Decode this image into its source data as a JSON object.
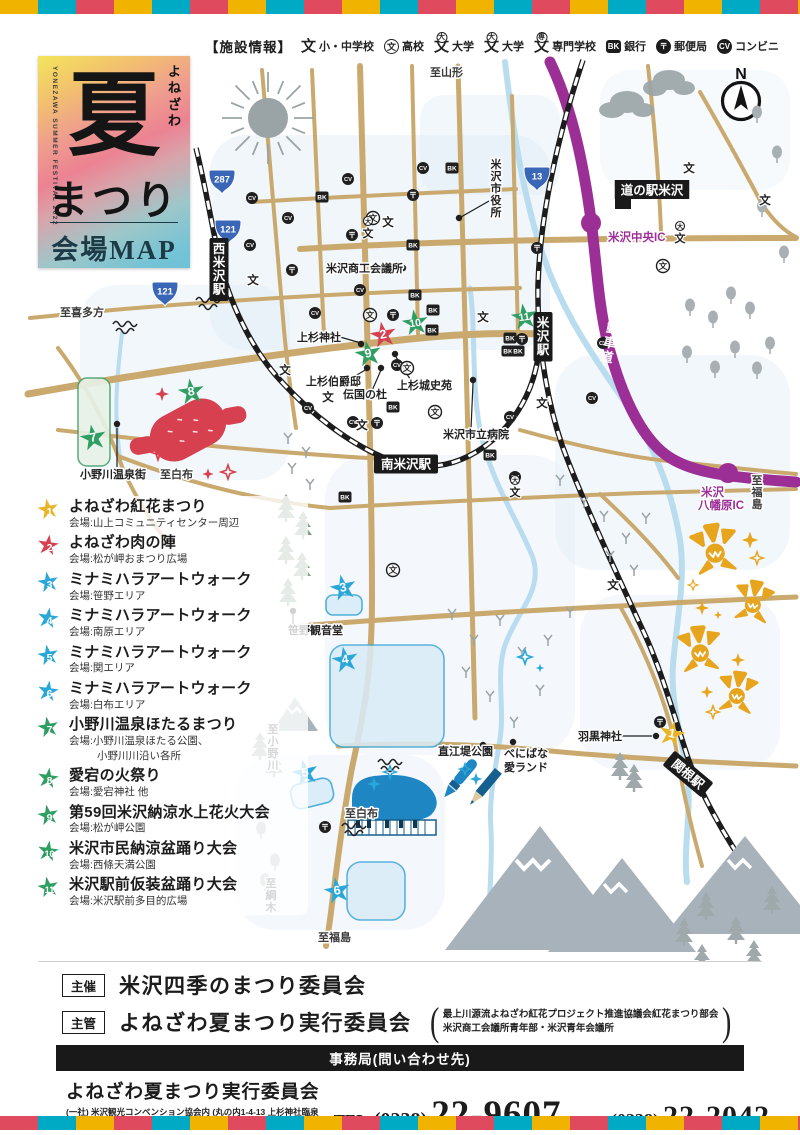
{
  "colors": {
    "stripe": [
      "#f0b400",
      "#00a9c4",
      "#e04a5e"
    ],
    "road_tan": "#c9a96e",
    "railway": "#1c1c1c",
    "expressway_purple": "#9c2f96",
    "river_blue": "#b9dcee",
    "star_yellow": "#e8b42a",
    "star_red": "#d6404f",
    "star_cyan": "#2aa7d8",
    "star_green": "#2f9e62"
  },
  "legend": {
    "title": "【施設情報】",
    "items": [
      {
        "icon": "elementary-junior-school-icon",
        "glyph": "文",
        "badge": "plain",
        "label": "小・中学校"
      },
      {
        "icon": "high-school-icon",
        "glyph": "文",
        "badge": "ring",
        "label": "高校"
      },
      {
        "icon": "university-icon",
        "glyph": "文",
        "badge": "大",
        "label": "大学"
      },
      {
        "icon": "university-icon-2",
        "glyph": "文",
        "badge": "大",
        "label": "大学"
      },
      {
        "icon": "vocational-school-icon",
        "glyph": "文",
        "badge": "専",
        "label": "専門学校"
      },
      {
        "icon": "bank-icon",
        "glyph": "BK",
        "badge": "square",
        "label": "銀行"
      },
      {
        "icon": "post-office-icon",
        "glyph": "〒",
        "badge": "disc",
        "label": "郵便局"
      },
      {
        "icon": "convenience-store-icon",
        "glyph": "CV",
        "badge": "disc",
        "label": "コンビニ"
      }
    ]
  },
  "title_card": {
    "vertical_en": "YONEZAWA SUMMER FESTIVAL 2022",
    "kana": "よねざわ",
    "logo_char": "夏",
    "subtitle": "まつり",
    "map_label": "会場MAP"
  },
  "map": {
    "compass_label": "N",
    "expressway_label": "東北中央自動車道",
    "shields": [
      {
        "num": "287",
        "x": 222,
        "y": 181
      },
      {
        "num": "121",
        "x": 228,
        "y": 231
      },
      {
        "num": "121",
        "x": 165,
        "y": 293
      },
      {
        "num": "13",
        "x": 537,
        "y": 178
      }
    ],
    "stations": [
      {
        "name": "南米沢駅",
        "x": 406,
        "y": 464,
        "o": "h",
        "rot": 0
      },
      {
        "name": "米沢駅",
        "x": 543,
        "y": 312,
        "o": "v"
      },
      {
        "name": "西米沢駅",
        "x": 219,
        "y": 238,
        "o": "v"
      },
      {
        "name": "関根駅",
        "x": 688,
        "y": 774,
        "o": "h",
        "rot": 40
      }
    ],
    "labels": [
      {
        "text": "N",
        "x": 741,
        "y": 79,
        "s": "compass"
      },
      {
        "text": "至山形",
        "x": 430,
        "y": 76,
        "s": "dir"
      },
      {
        "text": "至喜多方",
        "x": 60,
        "y": 316,
        "s": "dir"
      },
      {
        "text": "至白布",
        "x": 160,
        "y": 478,
        "s": "dir"
      },
      {
        "text": "至白布",
        "x": 345,
        "y": 817,
        "s": "dir"
      },
      {
        "text": "至福島",
        "x": 318,
        "y": 941,
        "s": "dir"
      },
      {
        "text": "至小野川",
        "x": 273,
        "y": 733,
        "s": "dirv"
      },
      {
        "text": "至綱木",
        "x": 271,
        "y": 887,
        "s": "dirv"
      },
      {
        "text": "至福島",
        "x": 757,
        "y": 484,
        "s": "dirv"
      },
      {
        "text": "米沢市役所",
        "x": 496,
        "y": 168,
        "s": "placev"
      },
      {
        "text": "道の駅米沢",
        "x": 652,
        "y": 190,
        "s": "blackbox"
      },
      {
        "text": "米沢中央IC",
        "x": 608,
        "y": 241,
        "s": "purple"
      },
      {
        "text": "米沢",
        "x": 701,
        "y": 496,
        "s": "purple"
      },
      {
        "text": "八幡原IC",
        "x": 698,
        "y": 509,
        "s": "purple"
      },
      {
        "text": "米沢商工会議所",
        "x": 326,
        "y": 272,
        "s": "place"
      },
      {
        "text": "上杉神社",
        "x": 297,
        "y": 341,
        "s": "place"
      },
      {
        "text": "上杉伯爵邸",
        "x": 306,
        "y": 385,
        "s": "place"
      },
      {
        "text": "伝国の杜",
        "x": 343,
        "y": 398,
        "s": "place"
      },
      {
        "text": "上杉城史苑",
        "x": 397,
        "y": 389,
        "s": "place"
      },
      {
        "text": "米沢市立病院",
        "x": 443,
        "y": 438,
        "s": "place"
      },
      {
        "text": "小野川温泉街",
        "x": 80,
        "y": 478,
        "s": "place"
      },
      {
        "text": "笹野観音堂",
        "x": 288,
        "y": 634,
        "s": "place"
      },
      {
        "text": "直江堤公園",
        "x": 438,
        "y": 755,
        "s": "place"
      },
      {
        "text": "べにばな",
        "x": 504,
        "y": 757,
        "s": "place"
      },
      {
        "text": "愛ランド",
        "x": 504,
        "y": 771,
        "s": "place"
      },
      {
        "text": "羽黒神社",
        "x": 578,
        "y": 740,
        "s": "place"
      }
    ],
    "stars": [
      {
        "n": 1,
        "x": 672,
        "y": 733,
        "rot": 12
      },
      {
        "n": 2,
        "x": 383,
        "y": 334,
        "rot": -10
      },
      {
        "n": 3,
        "x": 343,
        "y": 587,
        "rot": -12
      },
      {
        "n": 4,
        "x": 345,
        "y": 659,
        "rot": -10
      },
      {
        "n": 5,
        "x": 305,
        "y": 772,
        "rot": -12
      },
      {
        "n": 6,
        "x": 337,
        "y": 890,
        "rot": -10
      },
      {
        "n": 7,
        "x": 93,
        "y": 437,
        "rot": -10
      },
      {
        "n": 8,
        "x": 191,
        "y": 391,
        "rot": -8
      },
      {
        "n": 9,
        "x": 368,
        "y": 353,
        "rot": -10
      },
      {
        "n": 10,
        "x": 415,
        "y": 322,
        "rot": -8
      },
      {
        "n": 11,
        "x": 524,
        "y": 316,
        "rot": -8
      }
    ],
    "facility_icons": [
      {
        "t": "bk",
        "x": 322,
        "y": 197
      },
      {
        "t": "bk",
        "x": 452,
        "y": 168
      },
      {
        "t": "bk",
        "x": 413,
        "y": 245
      },
      {
        "t": "bk",
        "x": 415,
        "y": 295
      },
      {
        "t": "bk",
        "x": 433,
        "y": 310
      },
      {
        "t": "bk",
        "x": 432,
        "y": 330
      },
      {
        "t": "bk",
        "x": 510,
        "y": 338
      },
      {
        "t": "bk",
        "x": 508,
        "y": 351
      },
      {
        "t": "bk",
        "x": 518,
        "y": 351
      },
      {
        "t": "bk",
        "x": 393,
        "y": 407
      },
      {
        "t": "bk",
        "x": 490,
        "y": 455
      },
      {
        "t": "bk",
        "x": 345,
        "y": 497
      },
      {
        "t": "cv",
        "x": 348,
        "y": 179
      },
      {
        "t": "cv",
        "x": 252,
        "y": 198
      },
      {
        "t": "cv",
        "x": 288,
        "y": 218
      },
      {
        "t": "cv",
        "x": 250,
        "y": 245
      },
      {
        "t": "cv",
        "x": 423,
        "y": 168
      },
      {
        "t": "cv",
        "x": 360,
        "y": 290
      },
      {
        "t": "cv",
        "x": 315,
        "y": 313
      },
      {
        "t": "cv",
        "x": 397,
        "y": 365
      },
      {
        "t": "cv",
        "x": 308,
        "y": 408
      },
      {
        "t": "cv",
        "x": 353,
        "y": 422
      },
      {
        "t": "cv",
        "x": 510,
        "y": 417
      },
      {
        "t": "cv",
        "x": 515,
        "y": 477
      },
      {
        "t": "cv",
        "x": 603,
        "y": 343
      },
      {
        "t": "cv",
        "x": 592,
        "y": 398
      },
      {
        "t": "post",
        "x": 413,
        "y": 195
      },
      {
        "t": "post",
        "x": 352,
        "y": 235
      },
      {
        "t": "post",
        "x": 292,
        "y": 270
      },
      {
        "t": "post",
        "x": 537,
        "y": 248
      },
      {
        "t": "post",
        "x": 393,
        "y": 315
      },
      {
        "t": "post",
        "x": 522,
        "y": 339
      },
      {
        "t": "post",
        "x": 377,
        "y": 423
      },
      {
        "t": "post",
        "x": 325,
        "y": 827
      },
      {
        "t": "post",
        "x": 660,
        "y": 722
      },
      {
        "t": "school",
        "x": 388,
        "y": 222
      },
      {
        "t": "school",
        "x": 253,
        "y": 280
      },
      {
        "t": "school",
        "x": 285,
        "y": 370
      },
      {
        "t": "school",
        "x": 328,
        "y": 397
      },
      {
        "t": "school",
        "x": 362,
        "y": 425
      },
      {
        "t": "school",
        "x": 542,
        "y": 403
      },
      {
        "t": "school",
        "x": 483,
        "y": 317
      },
      {
        "t": "school",
        "x": 613,
        "y": 585
      },
      {
        "t": "school",
        "x": 689,
        "y": 168
      },
      {
        "t": "school",
        "x": 765,
        "y": 200
      },
      {
        "t": "hs",
        "x": 373,
        "y": 218
      },
      {
        "t": "hs",
        "x": 407,
        "y": 368
      },
      {
        "t": "hs",
        "x": 435,
        "y": 412
      },
      {
        "t": "hs",
        "x": 370,
        "y": 315
      },
      {
        "t": "hs",
        "x": 663,
        "y": 266
      },
      {
        "t": "hs",
        "x": 393,
        "y": 570
      },
      {
        "t": "univ",
        "x": 368,
        "y": 233
      },
      {
        "t": "univ",
        "x": 680,
        "y": 238
      },
      {
        "t": "univ",
        "x": 515,
        "y": 492
      }
    ],
    "poi_dots": [
      [
        403,
        268
      ],
      [
        361,
        344
      ],
      [
        367,
        368
      ],
      [
        381,
        368
      ],
      [
        395,
        354
      ],
      [
        473,
        380
      ],
      [
        459,
        218
      ],
      [
        117,
        424
      ],
      [
        293,
        611
      ],
      [
        483,
        745
      ],
      [
        513,
        742
      ],
      [
        656,
        736
      ]
    ],
    "leader_lines": [
      [
        340,
        337,
        361,
        343
      ],
      [
        350,
        379,
        367,
        369
      ],
      [
        371,
        393,
        381,
        370
      ],
      [
        412,
        382,
        396,
        357
      ],
      [
        471,
        429,
        473,
        383
      ],
      [
        489,
        201,
        461,
        217
      ],
      [
        117,
        428,
        117,
        467
      ],
      [
        293,
        614,
        293,
        627
      ],
      [
        600,
        736,
        652,
        736
      ]
    ]
  },
  "events": [
    {
      "num": "1",
      "color": "#e8b42a",
      "title": "よねざわ紅花まつり",
      "venue": "会場:山上コミュニティセンター周辺"
    },
    {
      "num": "2",
      "color": "#d6404f",
      "title": "よねざわ肉の陣",
      "venue": "会場:松が岬おまつり広場"
    },
    {
      "num": "3",
      "color": "#2aa7d8",
      "title": "ミナミハラアートウォーク",
      "venue": "会場:笹野エリア"
    },
    {
      "num": "4",
      "color": "#2aa7d8",
      "title": "ミナミハラアートウォーク",
      "venue": "会場:南原エリア"
    },
    {
      "num": "5",
      "color": "#2aa7d8",
      "title": "ミナミハラアートウォーク",
      "venue": "会場:関エリア"
    },
    {
      "num": "6",
      "color": "#2aa7d8",
      "title": "ミナミハラアートウォーク",
      "venue": "会場:白布エリア"
    },
    {
      "num": "7",
      "color": "#2f9e62",
      "title": "小野川温泉ほたるまつり",
      "venue": "会場:小野川温泉ほたる公園、",
      "venue2": "小野川川沿い各所"
    },
    {
      "num": "8",
      "color": "#2f9e62",
      "title": "愛宕の火祭り",
      "venue": "会場:愛宕神社 他"
    },
    {
      "num": "9",
      "color": "#2f9e62",
      "title": "第59回米沢納涼水上花火大会",
      "venue": "会場:松が岬公園"
    },
    {
      "num": "10",
      "color": "#2f9e62",
      "title": "米沢市民納涼盆踊り大会",
      "venue": "会場:西條天満公園"
    },
    {
      "num": "11",
      "color": "#2f9e62",
      "title": "米沢駅前仮装盆踊り大会",
      "venue": "会場:米沢駅前多目的広場"
    }
  ],
  "footer": {
    "organizer_label": "主催",
    "organizer": "米沢四季のまつり委員会",
    "manager_label": "主管",
    "manager": "よねざわ夏まつり実行委員会",
    "note_line1": "最上川源流よねざわ紅花プロジェクト推進協議会紅花まつり部会",
    "note_line2": "米沢商工会議所青年部・米沢青年会議所",
    "office_bar": "事務局(問い合わせ先)",
    "office_name": "よねざわ夏まつり実行委員会",
    "office_address": "(一社) 米沢観光コンベンション協会内 (丸の内1-4-13 上杉神社臨泉閣内)",
    "tel_label": "TEL.",
    "tel_area": "(0238)",
    "tel_number": "22-9607",
    "fax_label": "FAX.",
    "fax_area": "(0238)",
    "fax_number": "22-2042"
  }
}
